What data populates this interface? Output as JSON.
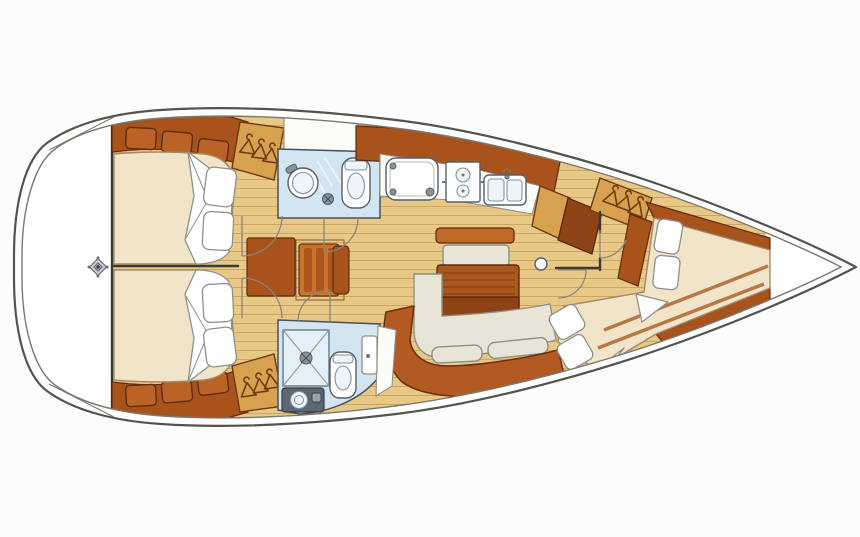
{
  "title": "Sailboat interior layout — top-down floor plan, bow to the right",
  "type": "yacht-floor-plan",
  "palette": {
    "page_bg": "#fcfcfc",
    "hull_line": "#55534e",
    "hull_inner_line": "#7a776f",
    "bulkhead": "#3a3a36",
    "wood_dark": "#a8521c",
    "wood_dark_edge": "#5f2c0e",
    "locker_face": "#bb6327",
    "wardrobe_tan": "#d8a150",
    "hanger_brown": "#6f3c10",
    "floor_tan": "#e7c887",
    "plank_line": "#cfa55f",
    "mattress": "#f2e4c9",
    "mattress_edge": "#a18b66",
    "linen_white": "#ffffff",
    "linen_edge": "#90908a",
    "settee_cream": "#e9e5d6",
    "settee_edge": "#8f8f85",
    "sofa_terracotta": "#b25a21",
    "sofa_edge": "#6b2f0d",
    "table_wood": "#a9571c",
    "table_wood_dark": "#8d4316",
    "bar_wood": "#bd6a24",
    "bath_blue": "#d2e5f0",
    "bath_tray": "#e3f0f7",
    "bath_edge": "#47525c",
    "fixture_white": "#ffffff",
    "fixture_edge": "#55606a",
    "counter_dark": "#5d6772",
    "counter_white": "#fbfbf8",
    "door_arc": "#8a867c",
    "seat_stripe": "#c8742e"
  },
  "rooms": [
    {
      "id": "stern-area",
      "name": "stern area with compass mark"
    },
    {
      "id": "aft-cabin-port",
      "name": "port aft double cabin with berth, lockers and wardrobe"
    },
    {
      "id": "aft-cabin-starboard",
      "name": "starboard aft double cabin with berth, lockers and wardrobe"
    },
    {
      "id": "head-port",
      "name": "port head with basin, shower and toilet"
    },
    {
      "id": "nav-station",
      "name": "chart table with seat"
    },
    {
      "id": "galley",
      "name": "linear galley with fridge, two-burner stove and double sink"
    },
    {
      "id": "saloon",
      "name": "saloon with dinette table, cream settee and curved sofa"
    },
    {
      "id": "head-starboard",
      "name": "starboard head with shower tray, toilet and vanity"
    },
    {
      "id": "forward-cabin",
      "name": "forward cabin with angled double berth"
    },
    {
      "id": "bow-deck",
      "name": "bow deck"
    }
  ],
  "icons": [
    "compass-rose-icon",
    "hanger-icon",
    "burner-icon",
    "sink-basin-icon",
    "toilet-icon",
    "shower-drain-icon",
    "mast-post-icon"
  ],
  "counts": {
    "hanging_lockers": 3,
    "pillows": 8,
    "door_swings": 7,
    "berths": 3
  }
}
